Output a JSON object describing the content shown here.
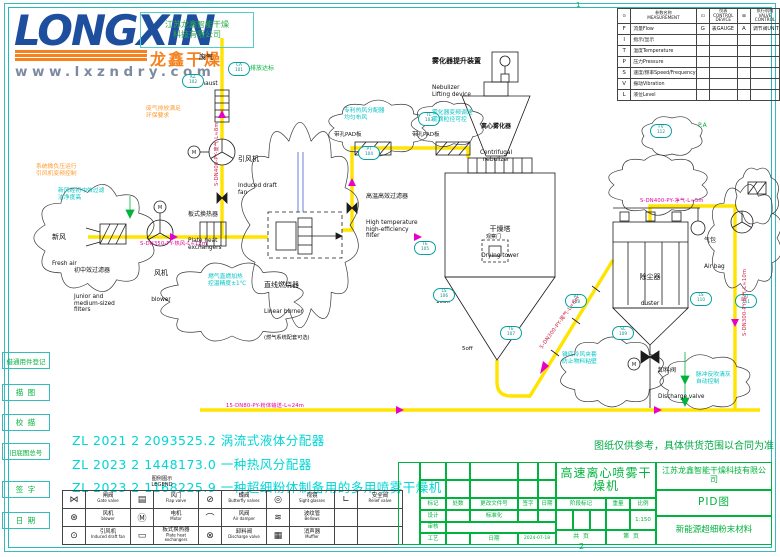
{
  "logo": {
    "brand": "LONGXIN",
    "brand_cn": "龙鑫干燥",
    "website": "www.lxzndry.com",
    "stamp": "江苏龙鑫智能干燥\n科技有限公司"
  },
  "frame": {
    "grid_ref_top": "1",
    "grid_ref_bottom": "2"
  },
  "margin_labels": [
    "借通用件登记",
    "描 图",
    "校 描",
    "旧底图总号",
    "签 字",
    "日 期"
  ],
  "instrument_table": {
    "headers": [
      "⊙",
      "参数名称\nMEASUREMENT",
      "⊡",
      "仪表\nCONTROL DEVICE",
      "⊠",
      "执行机构\nVALVE CONTROL"
    ],
    "rows": [
      [
        "F",
        "流量Flow",
        "G",
        "表GAUGE",
        "A",
        "调节阀UNIT"
      ],
      [
        "I",
        "指示/显示",
        "",
        "",
        "",
        ""
      ],
      [
        "T",
        "温度Temperature",
        "",
        "",
        "",
        ""
      ],
      [
        "P",
        "压力Pressure",
        "",
        "",
        "",
        ""
      ],
      [
        "S",
        "速度/频率Speed/Frequency",
        "",
        "",
        "",
        ""
      ],
      [
        "V",
        "振动Vibration",
        "",
        "",
        "",
        ""
      ],
      [
        "L",
        "液位Level",
        "",
        "",
        "",
        ""
      ]
    ]
  },
  "diagram": {
    "labels": {
      "exhaust": {
        "cn": "废气",
        "en": "Exhaust"
      },
      "induced_fan": {
        "cn": "引风机",
        "en": "Induced draft\nfan"
      },
      "fresh_air": {
        "cn": "新风",
        "en": "Fresh air"
      },
      "prefilter": {
        "cn": "初中效过滤器",
        "en": "Junior and\nmedium-sized\nfilters"
      },
      "blower": {
        "cn": "风机",
        "en": "blower"
      },
      "plate_hx": {
        "cn": "板式换热器",
        "en": "Plate heat\nexchangers"
      },
      "burner": {
        "cn": "直线燃烧器",
        "en": "Linear burner",
        "note": "(燃气系统配套可选)"
      },
      "pad_a": "带孔PAD板",
      "pad_b": "带孔PAD板",
      "htfilter": {
        "cn": "高温高效过滤器",
        "en": "High temperature\nhigh-efficiency\nfilter"
      },
      "neb_lift": {
        "cn": "雾化器提升装置",
        "en": "Nebulizer\nLifting device"
      },
      "nebulizer": {
        "cn": "离心雾化器",
        "en": "Centrifugal\nnebulizer"
      },
      "tower": {
        "cn": "干燥塔",
        "en": "Drying tower"
      },
      "sight_door": "观察门",
      "duster": {
        "cn": "除尘器",
        "en": "duster"
      },
      "air_bag": {
        "cn": "气包",
        "en": "Air bag"
      },
      "discharge": {
        "cn": "卸料阀",
        "en": "Discharge valve"
      },
      "off1": "10off",
      "off2": "5off",
      "pa": "P.A",
      "emission": "排放达标"
    },
    "itags": [
      "CA\n101",
      "KZ\n102",
      "TC\n103",
      "PT\n104",
      "TE\n105",
      "LS\n106",
      "TE\n107",
      "PT\n108",
      "SC\n109",
      "LS\n110",
      "PT\n111",
      "FV\n112"
    ],
    "pipe_tags": {
      "p1": "S-DN400-PY-废气-L≈8m",
      "p2": "S-DN350-PY-热风-L≈12m",
      "p3": "S-DN300-PY-尾气-L≈6m",
      "p4": "15-DN80-PY-粉体输送-L≈24m",
      "p5": "S-DN300-PY-尾气-L≈10m",
      "p6": "S-DN400-PY-净气-L≈5m"
    },
    "annotations": {
      "a1": "新风经初中效过滤\n洁净度高",
      "a2": "燃气直燃加热\n控温精度±1℃",
      "a3": "专利热风分配器\n均匀布风",
      "a4": "雾化器变频调速\n雾滴粒径可控",
      "a5": "锥底冷风夹套\n防止物料粘壁",
      "a6": "脉冲反吹清灰\n自动控制",
      "o1": "废气排放满足\n环保要求",
      "o2": "系统微负压运行\n引风机变频控制"
    }
  },
  "legend": {
    "title": "图例图示\nLEGEND",
    "rows": [
      [
        {
          "icon": "⋈",
          "cn": "闸阀",
          "en": "Gate valve"
        },
        {
          "icon": "▤",
          "cn": "风门",
          "en": "Flap valve"
        },
        {
          "icon": "⊘",
          "cn": "蝶阀",
          "en": "Butterfly valves"
        },
        {
          "icon": "◎",
          "cn": "视镜",
          "en": "Sight glasses"
        },
        {
          "icon": "∟",
          "cn": "安全阀",
          "en": "Relief valve"
        }
      ],
      [
        {
          "icon": "⊛",
          "cn": "风机",
          "en": "blower"
        },
        {
          "icon": "Ⓜ",
          "cn": "电机",
          "en": "Motor"
        },
        {
          "icon": "⌒",
          "cn": "风阀",
          "en": "Air damper"
        },
        {
          "icon": "≋",
          "cn": "波纹管",
          "en": "Bellows"
        },
        {
          "icon": "",
          "cn": "",
          "en": ""
        }
      ],
      [
        {
          "icon": "⊙",
          "cn": "引风机",
          "en": "Induced draft fan"
        },
        {
          "icon": "▭",
          "cn": "板式换热器",
          "en": "Plate heat exchangers"
        },
        {
          "icon": "⊗",
          "cn": "卸料阀",
          "en": "Discharge valve"
        },
        {
          "icon": "▦",
          "cn": "消声器",
          "en": "Muffler"
        },
        {
          "icon": "",
          "cn": "",
          "en": ""
        }
      ]
    ]
  },
  "patents": [
    "ZL 2021 2 2093525.2 涡流式液体分配器",
    "ZL 2023 2 1448173.0 一种热风分配器",
    "ZL 2023 2 1168225.9 一种超细粉体制备用的多用喷雾干燥机"
  ],
  "notice": "图纸仅供参考，具体供货范围以合同为准",
  "title_block": {
    "product_title": "高速离心喷雾干燥机",
    "company": "江苏龙鑫智能干燥科技有限公司",
    "doc_type": "PID图",
    "project": "新能源超细粉末材料",
    "hdr_mark": "标记",
    "hdr_count": "处数",
    "hdr_file": "更改文件号",
    "hdr_sign": "签字",
    "hdr_date": "日期",
    "design": "设计",
    "standard": "标准化",
    "audit": "审核",
    "process": "工艺",
    "date_label": "日期",
    "date_value": "2024-07-18",
    "stage": "阶段标记",
    "weight": "重量",
    "scale": "比例",
    "scale_value": "1:150",
    "total_pages": "共  页",
    "page_no": "第  页"
  }
}
